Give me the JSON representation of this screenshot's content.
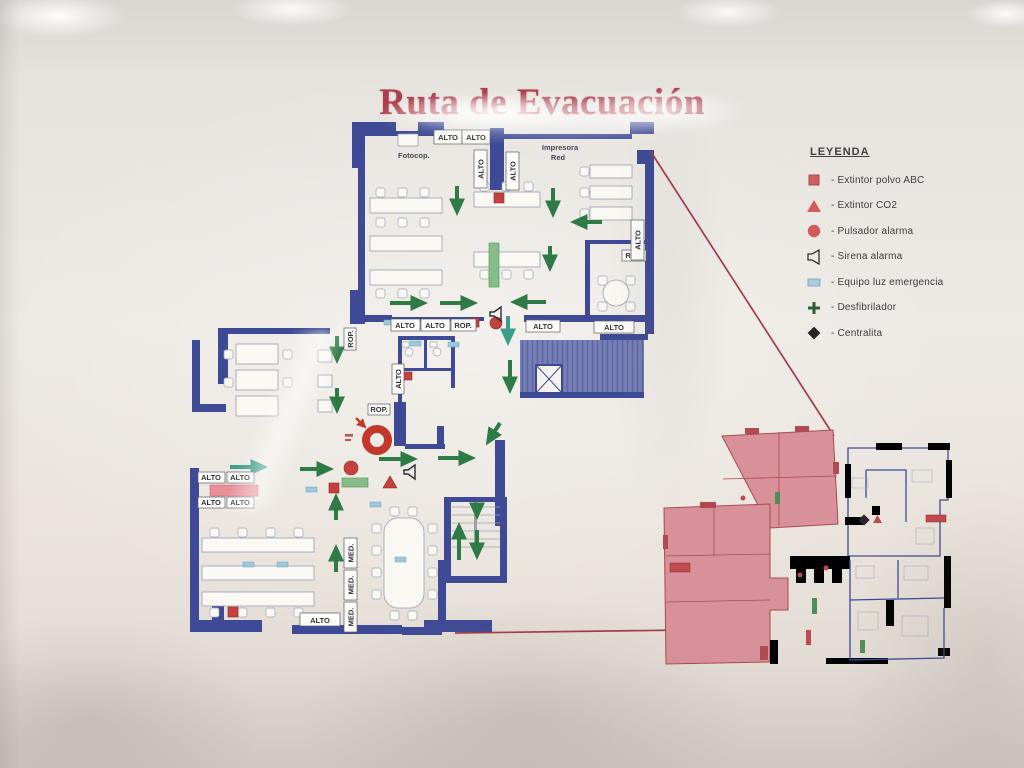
{
  "poster": {
    "title": "Ruta de Evacuación"
  },
  "legend": {
    "heading": "LEYENDA",
    "items": [
      {
        "name": "extintor-polvo-abc",
        "label": "- Extintor polvo ABC"
      },
      {
        "name": "extintor-co2",
        "label": "- Extintor CO2"
      },
      {
        "name": "pulsador-alarma",
        "label": "- Pulsador alarma"
      },
      {
        "name": "sirena-alarma",
        "label": "- Sirena alarma"
      },
      {
        "name": "equipo-luz-emergencia",
        "label": "- Equipo luz emergencia"
      },
      {
        "name": "desfibrilador",
        "label": "- Desfibrilador"
      },
      {
        "name": "centralita",
        "label": "- Centralita"
      }
    ]
  },
  "plan": {
    "labels": {
      "alto": "ALTO",
      "rop": "ROP.",
      "med": "MED.",
      "fotocop": "Fotocop.",
      "impresora_1": "Impresora",
      "impresora_2": "Red"
    },
    "colors": {
      "wall_blue": "#3e4a96",
      "evacuation_arrow_green": "#2e7b45",
      "route_line_red": "#a23c44",
      "symbol_red": "#c5413d",
      "emergency_light_blue": "#9cc8de",
      "defibrillator_green": "#86bd8a",
      "highlight_pink": "#d99199",
      "title_red": "#ad3c4c"
    }
  }
}
